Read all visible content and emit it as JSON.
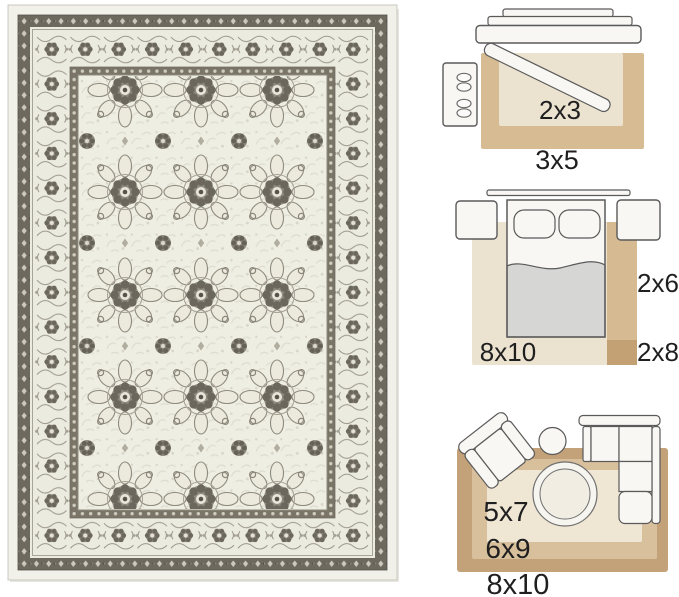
{
  "image_type": "rug product listing image with size guide diagrams",
  "rug_photo": {
    "description": "distressed oriental medallion area rug, ivory and grey",
    "colors": {
      "binding": "#f1f0e9",
      "border_dark": "#6e695e",
      "border_ivory": "#ecebdf",
      "field": "#efeee3",
      "motif": "#8f8b7e",
      "motif_dark": "#6b675c"
    }
  },
  "size_guide": {
    "text_color": "#1f1f1f",
    "outline_color": "#5a5a5a",
    "furniture_fill": "#f8f7f4",
    "entryway": {
      "furniture": [
        "door-threshold",
        "door-leaf",
        "shoe-cabinet"
      ],
      "inner_rug": {
        "label": "2x3",
        "color": "#ebe2cf"
      },
      "outer_rug": {
        "label": "3x5",
        "color": "#d6bb93"
      }
    },
    "bedroom": {
      "furniture": [
        "headboard",
        "bed",
        "pillows",
        "nightstand-left",
        "nightstand-right"
      ],
      "area_rug": {
        "label": "8x10",
        "color": "#ece2d0"
      },
      "runner": {
        "label": "2x6",
        "color": "#d6ba92"
      },
      "runner_long": {
        "label": "2x8",
        "color": "#c4a175"
      }
    },
    "living_room": {
      "furniture": [
        "armchair",
        "side-table",
        "sectional-sofa",
        "round-coffee-table"
      ],
      "small_rug": {
        "label": "5x7",
        "color": "#efe6d4"
      },
      "medium_rug": {
        "label": "6x9",
        "color": "#d9c09c"
      },
      "large_rug": {
        "label": "8x10",
        "color": "#c3a179"
      }
    }
  }
}
